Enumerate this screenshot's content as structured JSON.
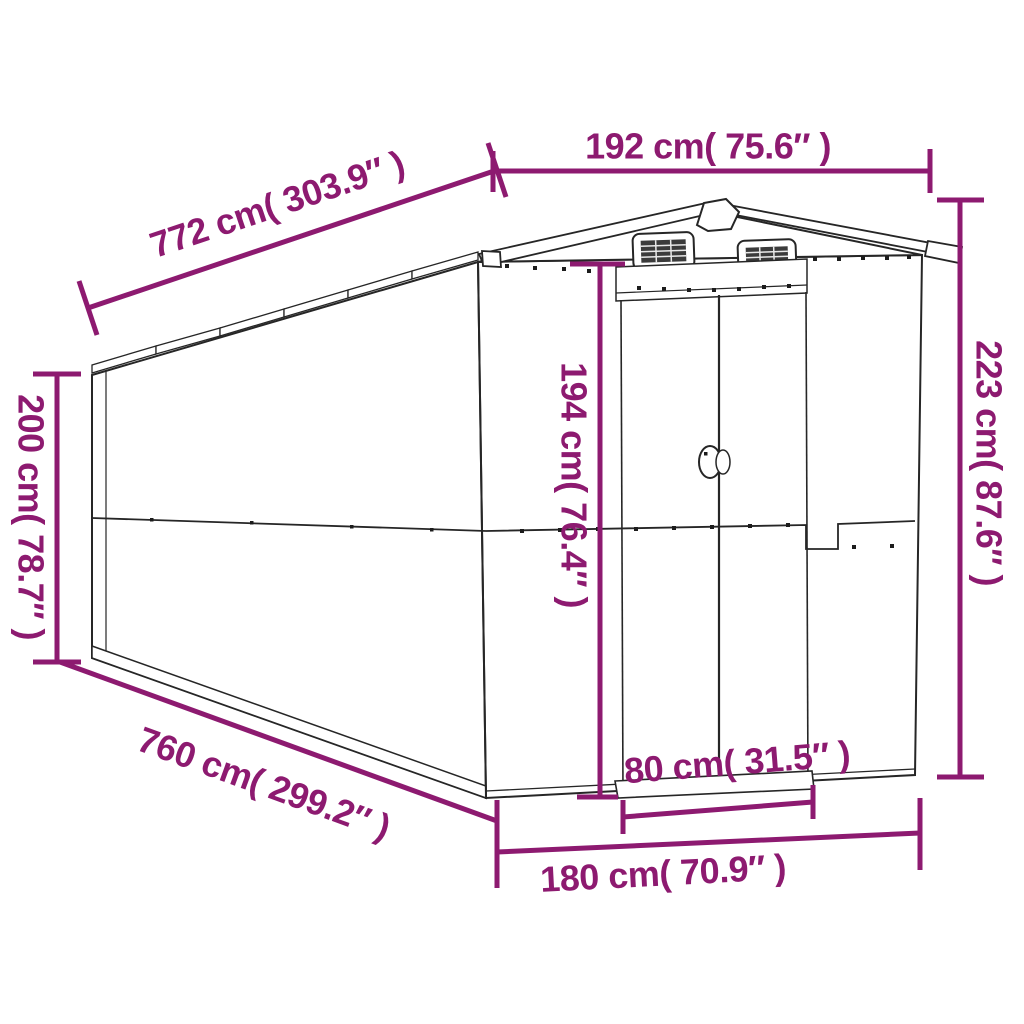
{
  "title": "Garden shed dimension diagram",
  "palette": {
    "dimension_color": "#8D1A70",
    "outline_color": "#262626",
    "background": "#ffffff"
  },
  "labels": {
    "width_top": "192 cm( 75.6″ )",
    "length_top": "772 cm( 303.9″ )",
    "height_right": "223 cm( 87.6″ )",
    "height_left": "200 cm( 78.7″ )",
    "door_height": "194 cm( 76.4″ )",
    "length_bottom": "760 cm( 299.2″ )",
    "door_width": "80 cm( 31.5″ )",
    "width_bottom": "180 cm( 70.9″ )"
  }
}
